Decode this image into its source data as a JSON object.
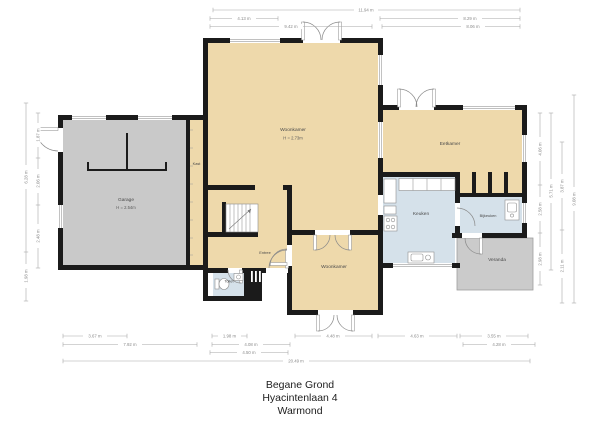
{
  "title": [
    "Begane Grond",
    "Hyacintenlaan 4",
    "Warmond"
  ],
  "rooms": {
    "garage": {
      "label": "Garage",
      "height": "H = 2.54m"
    },
    "kast": {
      "label": "Kast"
    },
    "woonkamer": {
      "label": "Woonkamer",
      "height": "H = 2.73m"
    },
    "woonkamer_2": {
      "label": "Woonkamer"
    },
    "entree": {
      "label": "Entree"
    },
    "toilet": {
      "label": "Toilet"
    },
    "eetkamer": {
      "label": "Eetkamer"
    },
    "keuken": {
      "label": "Keuken"
    },
    "bijkeuken": {
      "label": "Bijkeuken"
    },
    "veranda": {
      "label": "Veranda"
    }
  },
  "dimensions": {
    "top": [
      "11.94 m",
      "4.13 m",
      "8.29 m",
      "9.42 m",
      "8.06 m"
    ],
    "bottom": [
      "3.67 m",
      "1.98 m",
      "4.48 m",
      "4.63 m",
      "3.55 m",
      "7.92 m",
      "4.08 m",
      "4.28 m",
      "4.50 m",
      "20.49 m"
    ],
    "left": [
      "6.28 m",
      "1.98 m",
      "1.87 m",
      "2.06 m",
      "2.48 m"
    ],
    "right": [
      "4.06 m",
      "2.58 m",
      "2.98 m",
      "5.71 m",
      "3.87 m",
      "2.11 m",
      "9.08 m"
    ]
  },
  "colors": {
    "floor_living": "#eed9ab",
    "floor_wet": "#d5e1ea",
    "floor_garage": "#c9c9c9",
    "wall": "#1b1b1b",
    "dimension_line": "#a8a8a8"
  }
}
